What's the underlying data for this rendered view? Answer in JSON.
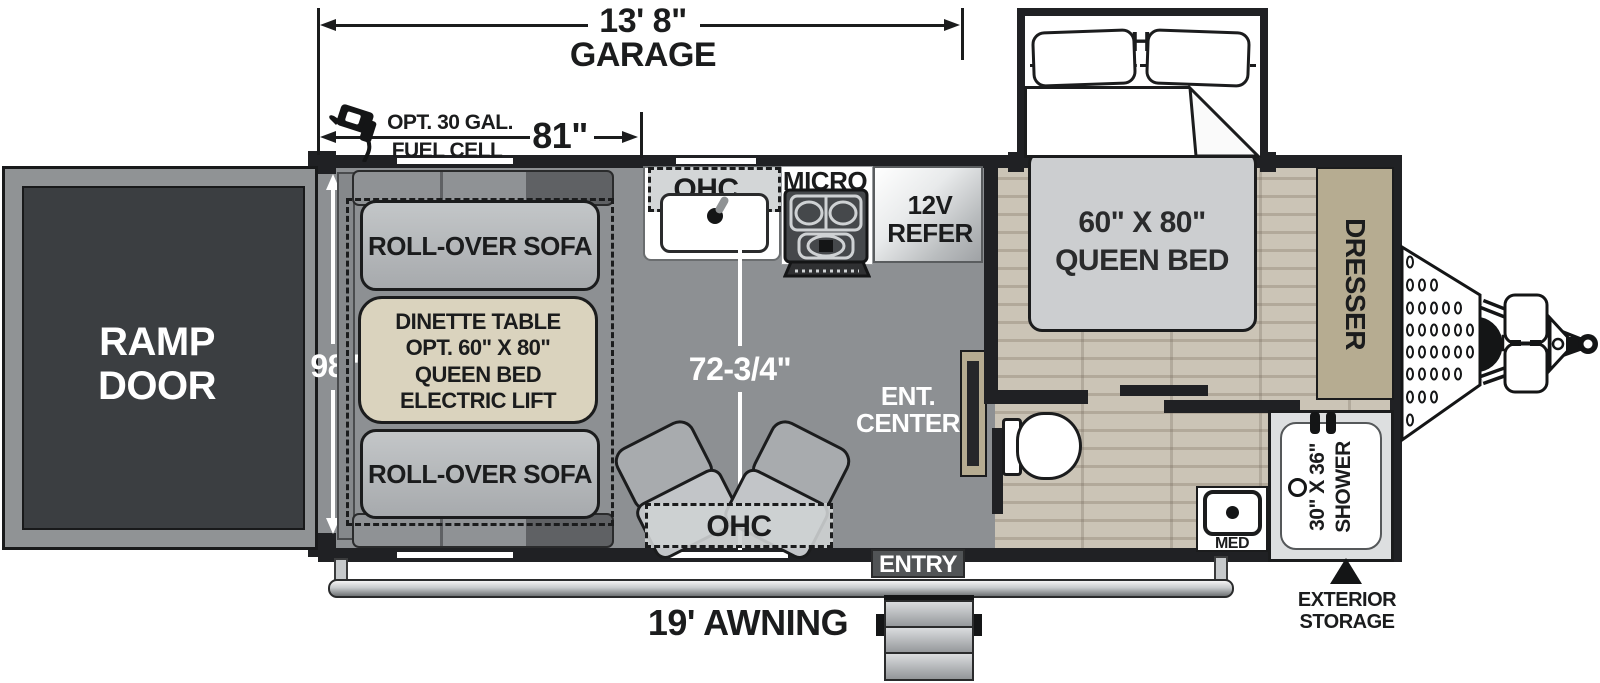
{
  "dimensions": {
    "garage_length": "13' 8\"",
    "garage_label": "GARAGE",
    "fuel_opt_line1": "OPT. 30 GAL.",
    "fuel_opt_line2": "FUEL CELL",
    "fuel_width": "81\"",
    "body_width": "98\"",
    "interior_length": "72-3/4\"",
    "awning_label": "19' AWNING"
  },
  "garage": {
    "ramp_line1": "RAMP",
    "ramp_line2": "DOOR",
    "sofa_top": "ROLL-OVER SOFA",
    "sofa_bottom": "ROLL-OVER SOFA",
    "dinette_line1": "DINETTE TABLE",
    "dinette_line2": "OPT. 60\" X 80\"",
    "dinette_line3": "QUEEN BED",
    "dinette_line4": "ELECTRIC LIFT",
    "ohc": "OHC"
  },
  "kitchen": {
    "ohc": "OHC",
    "micro": "MICRO",
    "refer_line1": "12V",
    "refer_line2": "REFER",
    "ent_line1": "ENT.",
    "ent_line2": "CENTER"
  },
  "bedroom": {
    "ohc": "OHC",
    "bed_line1": "60\" X 80\"",
    "bed_line2": "QUEEN BED",
    "dresser": "DRESSER"
  },
  "bath": {
    "shower_line1": "30\" X 36\"",
    "shower_line2": "SHOWER",
    "med": "MED"
  },
  "exterior": {
    "entry": "ENTRY",
    "storage_line1": "EXTERIOR",
    "storage_line2": "STORAGE"
  },
  "colors": {
    "wall": "#202124",
    "garage_floor": "#8d9093",
    "wood_floor_light": "#cbc4b6",
    "wood_floor_dark": "#b4ab9c",
    "cabinet_tan": "#b6ac91",
    "dinette_tan": "#dad3be",
    "sofa_gray": "#b0b3b6",
    "ramp_door_gray": "#3b3e41",
    "dimension_white": "#ffffff",
    "line_black": "#1b1c1d"
  }
}
